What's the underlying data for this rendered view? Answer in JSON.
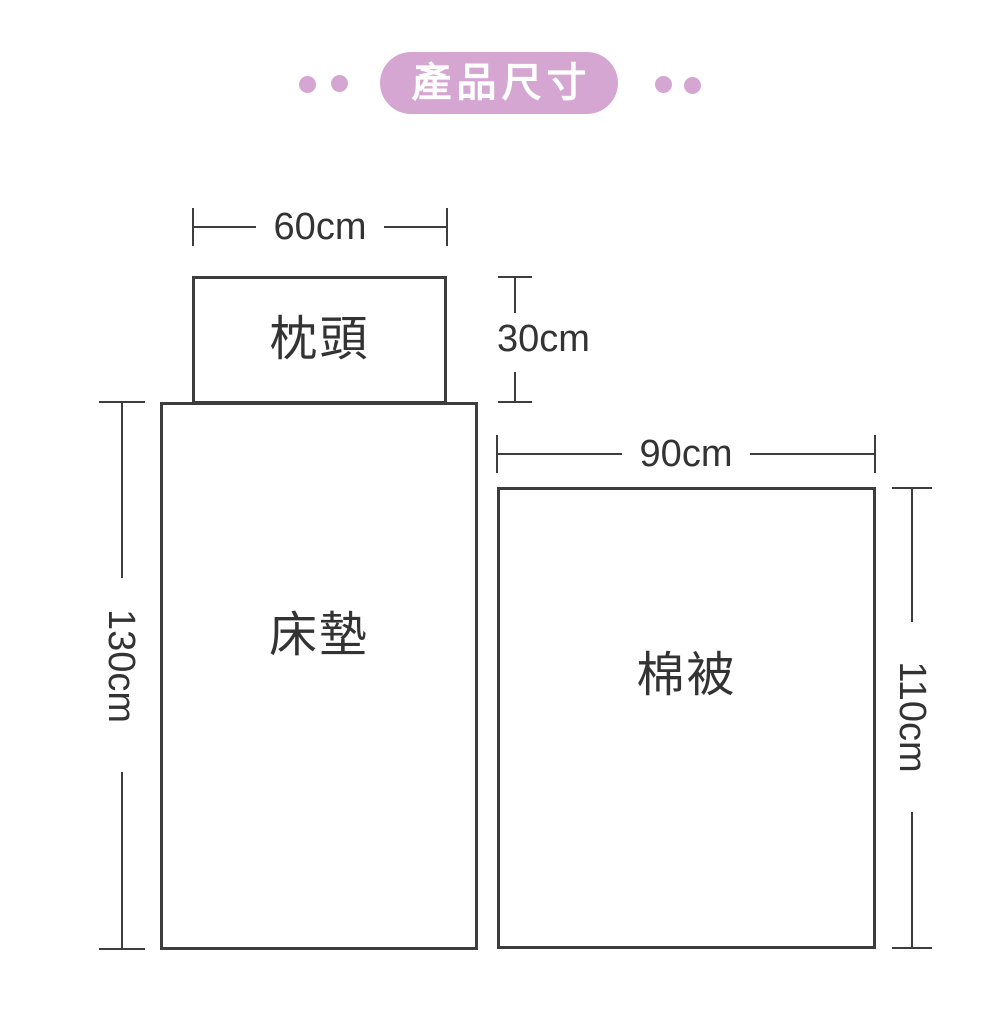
{
  "badge": {
    "label": "產品尺寸"
  },
  "colors": {
    "accent_pink": "#D5A6D2",
    "line": "#3D3D3D",
    "text": "#333333",
    "badge_text": "#FFFFFF",
    "background": "#FFFFFF"
  },
  "pillow": {
    "label": "枕頭",
    "width": "60cm",
    "height": "30cm"
  },
  "mattress": {
    "label": "床墊",
    "height": "130cm"
  },
  "quilt": {
    "label": "棉被",
    "width": "90cm",
    "height": "110cm"
  }
}
